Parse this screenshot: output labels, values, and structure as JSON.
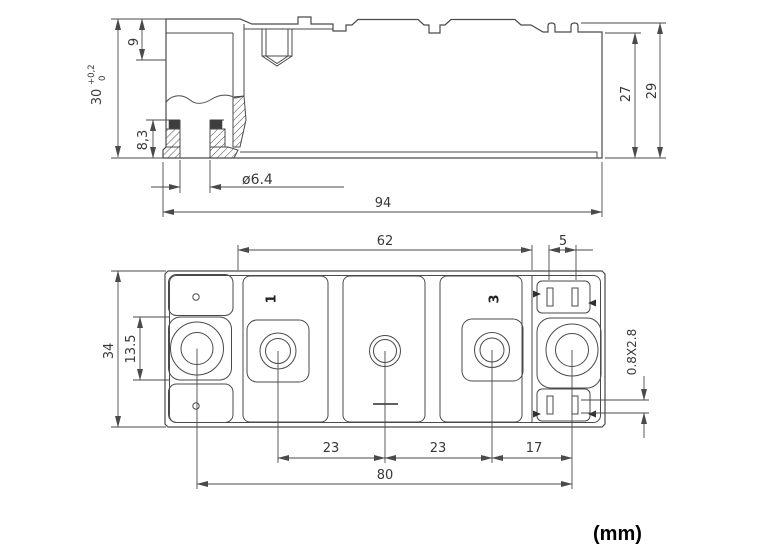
{
  "note": "(mm)",
  "side_view": {
    "overall_height": "30",
    "tol_upper": "+0,2",
    "tol_lower": "0",
    "terminal_recess": "9",
    "bushing_height": "8,3",
    "hole_dia": "ø6.4",
    "length": "94",
    "body_height": "27",
    "pin_height": "29"
  },
  "plan_view": {
    "terminal_span": "62",
    "tab_gap": "5",
    "width": "34",
    "boss_size": "13.5",
    "pitch_a": "23",
    "pitch_b": "23",
    "pitch_c": "17",
    "mounting_span": "80",
    "tab_section": "0.8X2.8",
    "terminal1": "1",
    "terminal3": "3"
  }
}
